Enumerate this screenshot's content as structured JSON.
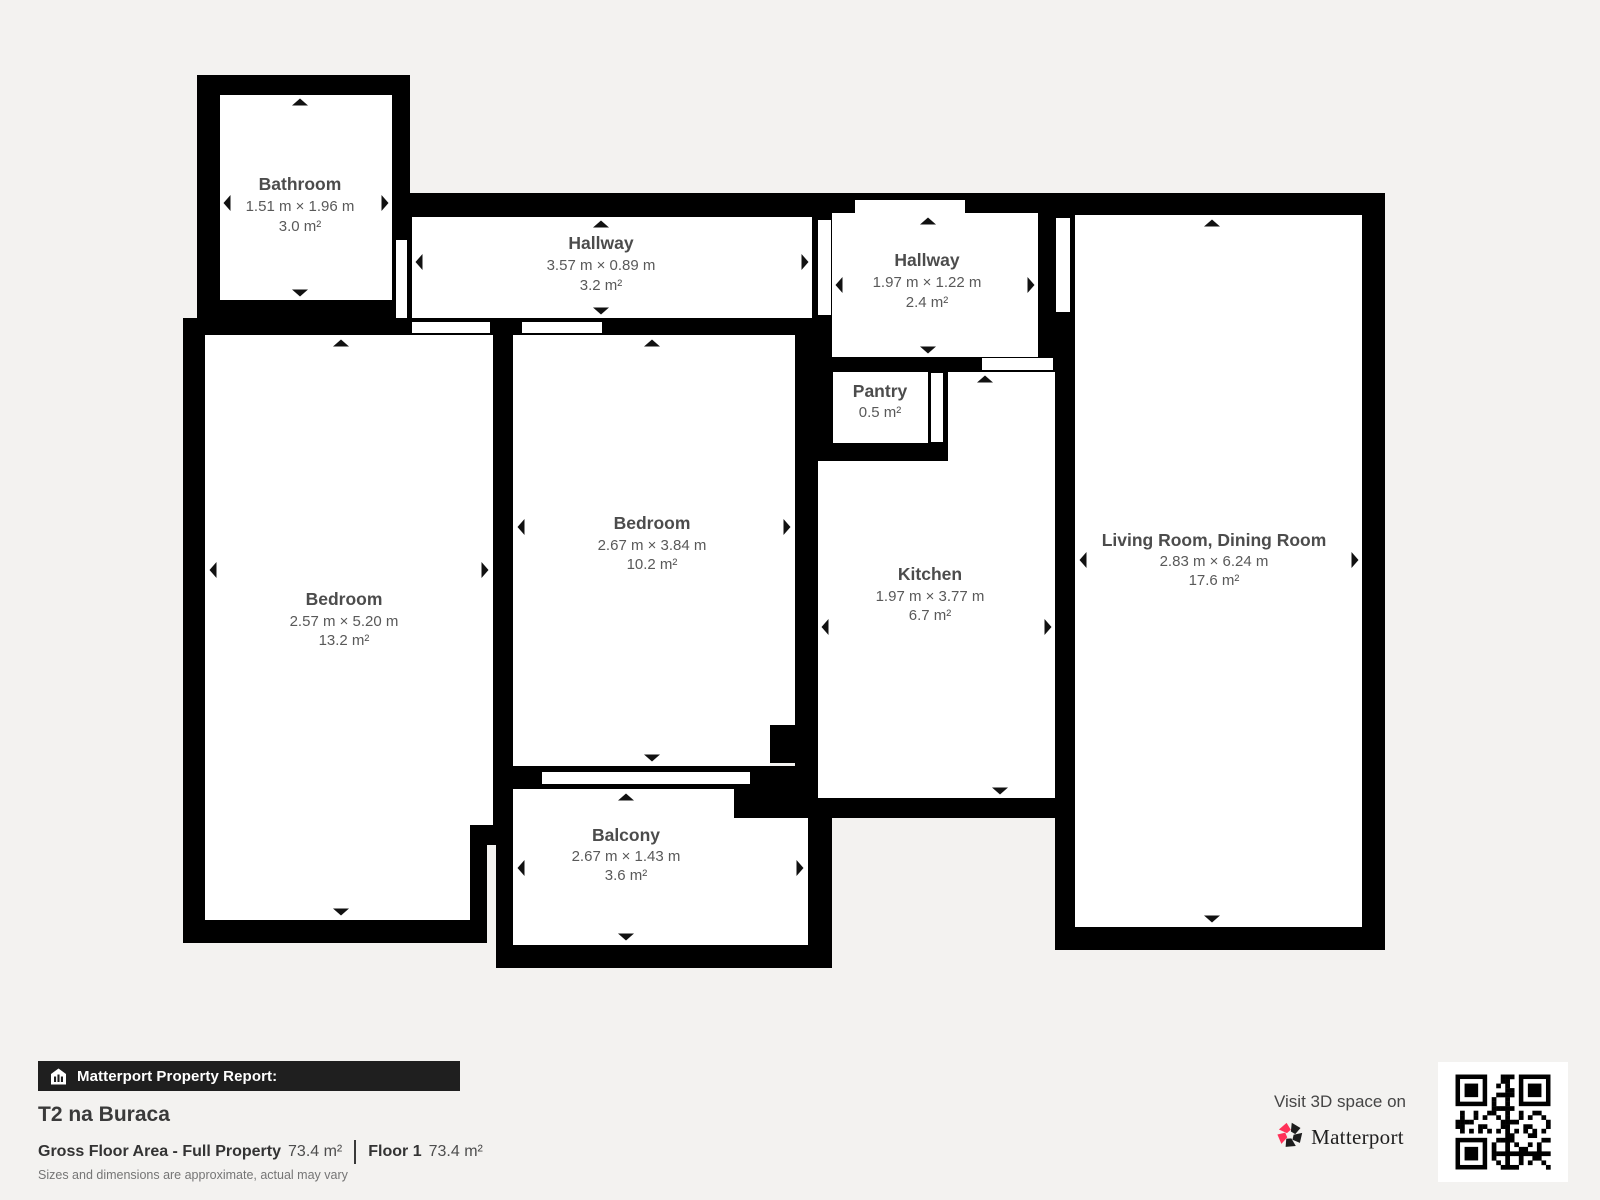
{
  "rooms": {
    "bathroom": {
      "name": "Bathroom",
      "dims": "1.51 m × 1.96 m",
      "area": "3.0 m²"
    },
    "hallway1": {
      "name": "Hallway",
      "dims": "3.57 m × 0.89 m",
      "area": "3.2 m²"
    },
    "hallway2": {
      "name": "Hallway",
      "dims": "1.97 m × 1.22 m",
      "area": "2.4 m²"
    },
    "pantry": {
      "name": "Pantry",
      "area": "0.5 m²"
    },
    "bedroom_left": {
      "name": "Bedroom",
      "dims": "2.57 m × 5.20 m",
      "area": "13.2 m²"
    },
    "bedroom_center": {
      "name": "Bedroom",
      "dims": "2.67 m × 3.84 m",
      "area": "10.2 m²"
    },
    "kitchen": {
      "name": "Kitchen",
      "dims": "1.97 m × 3.77 m",
      "area": "6.7 m²"
    },
    "living_room": {
      "name": "Living Room, Dining Room",
      "dims": "2.83 m × 6.24 m",
      "area": "17.6 m²"
    },
    "balcony": {
      "name": "Balcony",
      "dims": "2.67 m × 1.43 m",
      "area": "3.6 m²"
    }
  },
  "footer": {
    "report_label": "Matterport Property Report:",
    "property_title": "T2 na Buraca",
    "gross_floor_area_label": "Gross Floor Area - Full Property",
    "gross_floor_area_value": "73.4 m²",
    "floor_label": "Floor 1",
    "floor_value": "73.4 m²",
    "disclaimer": "Sizes and dimensions are approximate, actual may vary"
  },
  "promo": {
    "visit_text": "Visit 3D space on",
    "brand": "Matterport"
  },
  "colors": {
    "background": "#f3f2f0",
    "wall": "#000000",
    "room_fill": "#ffffff",
    "label_text": "#4c4c4c",
    "brand_pink": "#ff3158",
    "bar_background": "#1f1f1f"
  }
}
